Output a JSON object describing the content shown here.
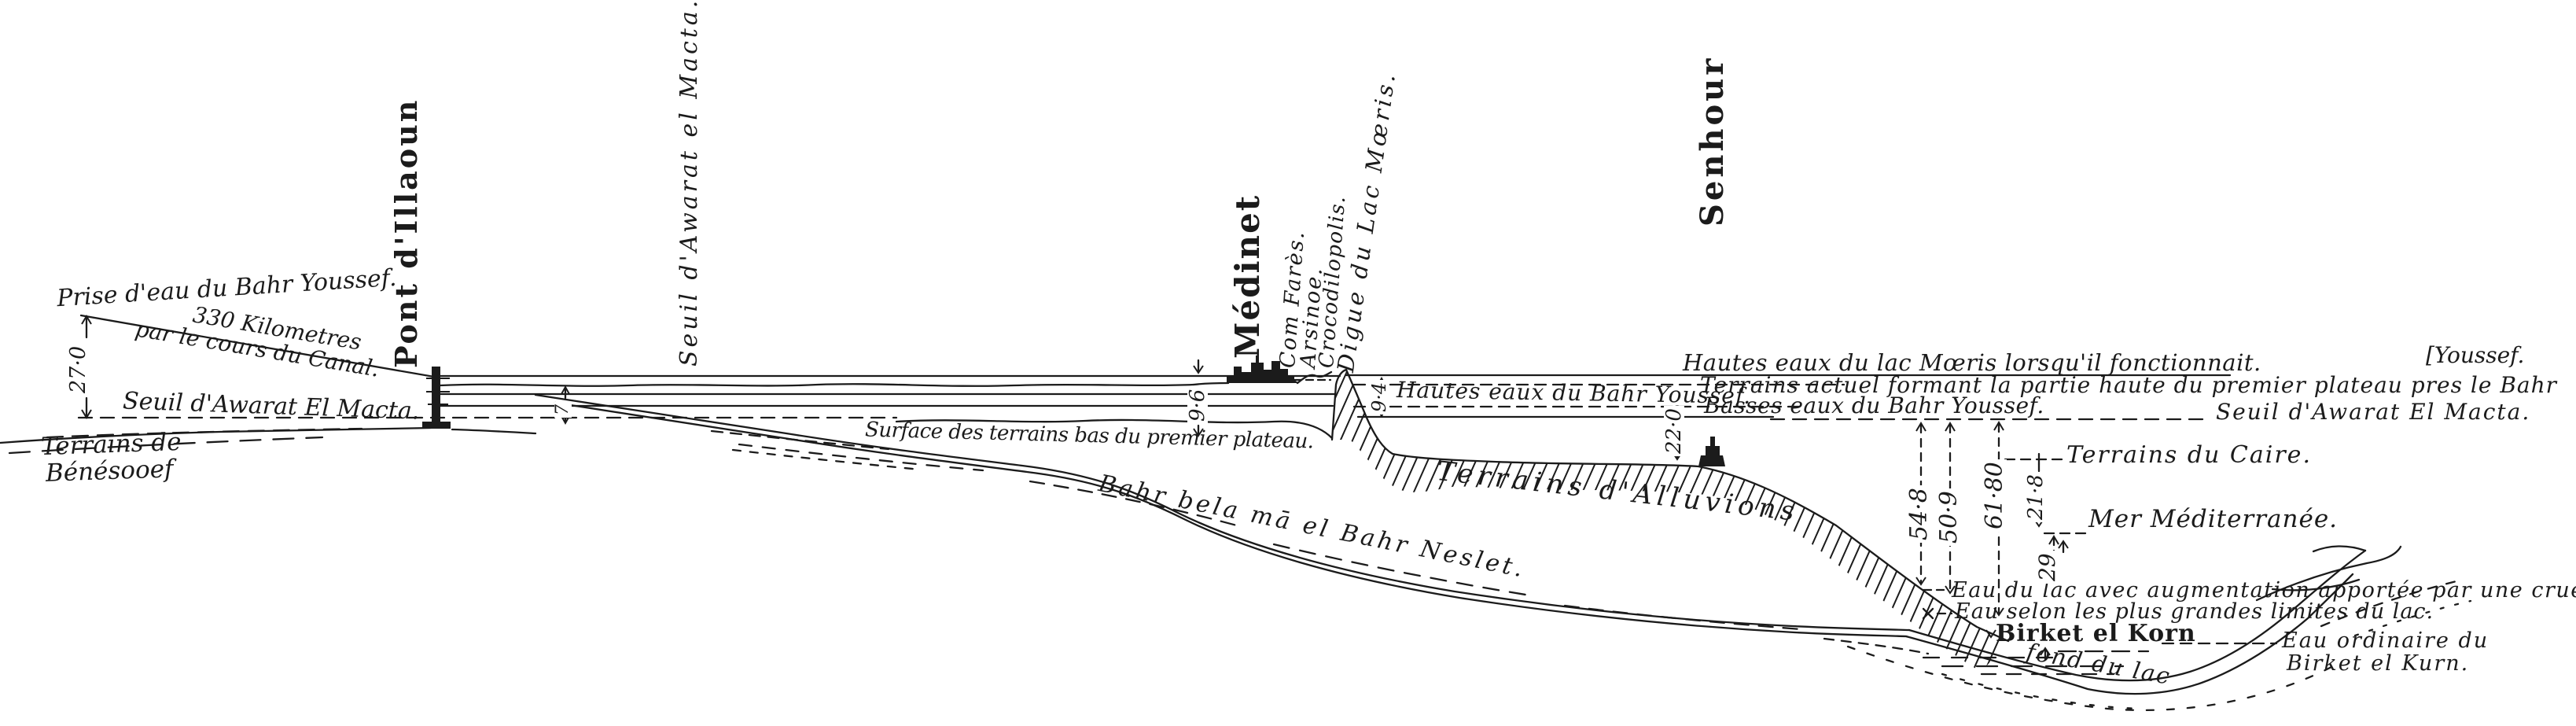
{
  "colors": {
    "ink": "#1b1b1b",
    "paper": "#ffffff"
  },
  "labels": {
    "prise_deau": "Prise d'eau du Bahr Youssef.",
    "km_330": "330 Kilometres",
    "cours_canal": "par le cours du Canal.",
    "seuil_macta_left": "Seuil d'Awarat El Macta.",
    "terrains_benesooef_1": "Terrains de",
    "terrains_benesooef_2": "Bénésooef",
    "pont_dillaoun": "Pont d'Illaoun",
    "seuil_macta_vertical": "Seuil d'Awarat el Macta.",
    "surface_terrains": "Surface des terrains bas du premier plateau.",
    "bahr_bela": "Bahr bela mā el Bahr Neslet.",
    "medinet": "Médinet",
    "com_fares": "Com Farès.",
    "arsinoe": "Arsinoe.",
    "crocodilopolis": "Crocodilopolis.",
    "digue_lac_moeris": "Digue du Lac Mœris.",
    "hautes_eaux_bahr": "Hautes eaux du Bahr Youssef.",
    "hautes_eaux_lac": "Hautes eaux du lac Mœris lorsqu'il fonctionnait.",
    "terrains_actuel": "Terrains actuel formant la partie haute du premier plateau pres le Bahr",
    "youssef_turnover": "[Youssef.",
    "basses_eaux_bahr": "Basses eaux du Bahr Youssef.",
    "seuil_macta_right": "Seuil d'Awarat El Macta.",
    "terrains_alluvions": "Terrains d'Alluvions",
    "senhour": "Senhour",
    "terrains_caire": "Terrains du Caire.",
    "mer_mediterranee": "Mer Méditerranée.",
    "eau_crue": "Eau du lac avec augmentation apportée par une crue.",
    "eau_limites": "Eau selon les plus grandes limites du lac.",
    "birket_el_korn": "Birket el Korn",
    "fond_du_lac": "fond du lac",
    "eau_ordinaire_1": "Eau ordinaire du",
    "eau_ordinaire_2": "Birket el Kurn."
  },
  "measurements": {
    "canal_head_drop": "27·0",
    "seuil_depth": "7",
    "medinet_height": "9·6",
    "digue_height": "9·4",
    "alluvion_depth": "22·0",
    "lake_depth_a": "54·8",
    "lake_depth_b": "50·9",
    "lake_depth_c": "61·80",
    "caire_height": "21·8",
    "mer_height": "29"
  }
}
